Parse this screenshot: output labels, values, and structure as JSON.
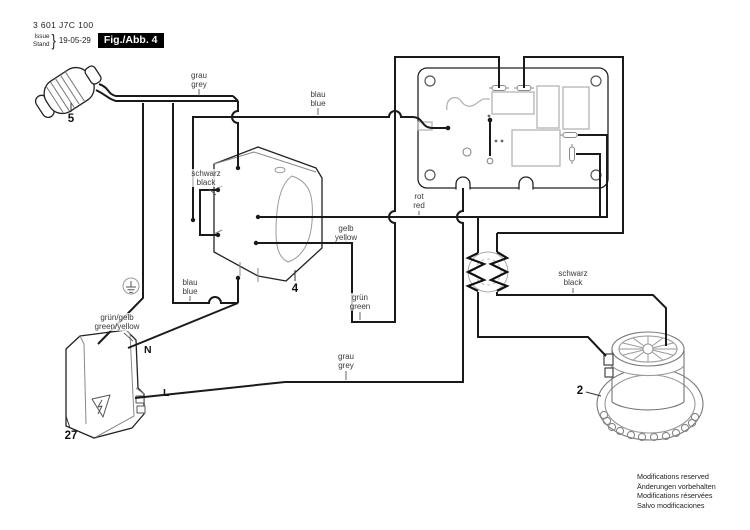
{
  "header": {
    "part_number": "3 601 J7C 100",
    "issue_label": "Issue",
    "stand_label": "Stand",
    "brace": "}",
    "date": "19-05-29",
    "figure_label": "Fig./Abb. 4"
  },
  "wire_labels": {
    "grau_grey_top": "grau\ngrey",
    "blau_blue_top": "blau\nblue",
    "schwarz_black_switch": "schwarz\nblack",
    "gelb_yellow": "gelb\nyellow",
    "rot_red": "rot\nred",
    "blau_blue_lower": "blau\nblue",
    "gruen_green": "grün\ngreen",
    "gruen_gelb_green_yellow": "grün/gelb\ngreen/yellow",
    "grau_grey_bottom": "grau\ngrey",
    "schwarz_black_right": "schwarz\nblack"
  },
  "terminal_labels": {
    "neutral": "N",
    "line": "L"
  },
  "callouts": {
    "plug": "5",
    "switch": "4",
    "motor": "2",
    "socket": "27"
  },
  "footer": {
    "notice": "Modifications reserved\nÄnderungen vorbehalten\nModifications réservées\nSalvo modificaciones"
  },
  "colors": {
    "line": "#1a1a1a",
    "light_detail": "#9a9a9a",
    "badge_bg": "#000000",
    "badge_fg": "#ffffff"
  }
}
